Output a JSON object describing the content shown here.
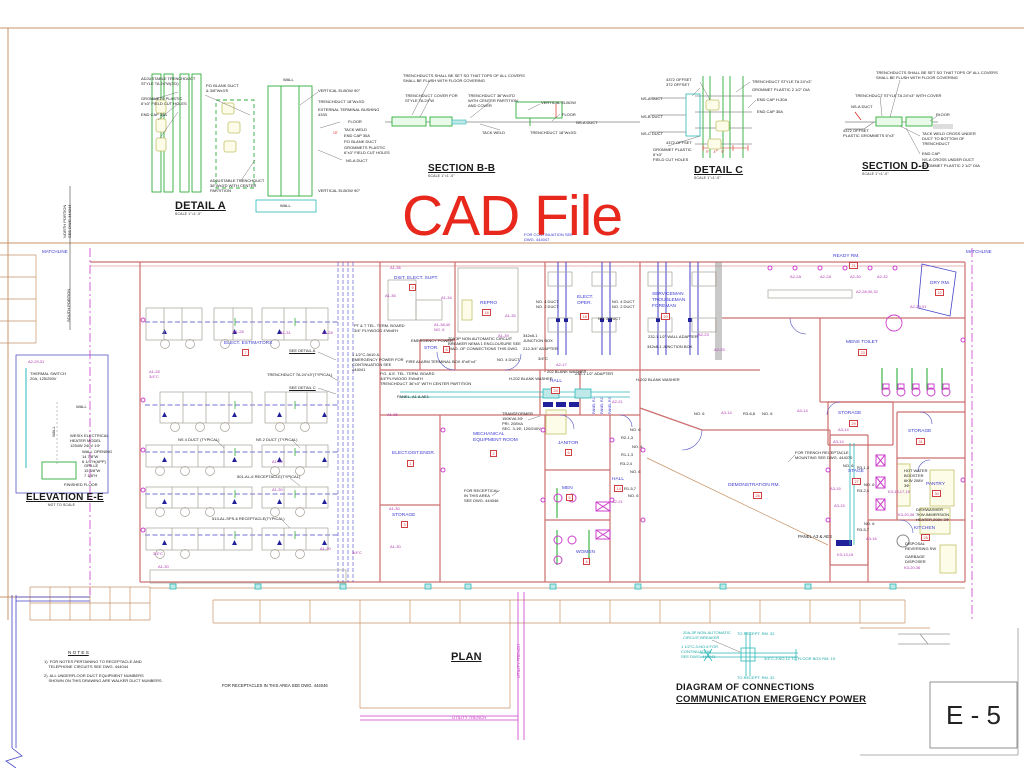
{
  "watermark": {
    "text": "CAD File",
    "color": "#e8281c"
  },
  "sheet": {
    "number": "E - 5"
  },
  "titles": [
    {
      "t": "DETAIL A",
      "x": 175,
      "y": 200,
      "s": 11,
      "u": 1
    },
    {
      "t": "SCALE 1\"=1'-0\"",
      "x": 175,
      "y": 212,
      "s": 3.4,
      "b": 0
    },
    {
      "t": "SECTION B-B",
      "x": 428,
      "y": 163,
      "s": 10,
      "u": 1
    },
    {
      "t": "SCALE 1\"=1'-0\"",
      "x": 428,
      "y": 174,
      "s": 3.4,
      "b": 0
    },
    {
      "t": "DETAIL C",
      "x": 694,
      "y": 164,
      "s": 10.5,
      "u": 1
    },
    {
      "t": "SCALE 1\"=1'-0\"",
      "x": 694,
      "y": 176,
      "s": 3.4,
      "b": 0
    },
    {
      "t": "SECTION D-D",
      "x": 862,
      "y": 161,
      "s": 10,
      "u": 1
    },
    {
      "t": "SCALE 1\"=1'-0\"",
      "x": 862,
      "y": 172,
      "s": 3.4,
      "b": 0
    },
    {
      "t": "ELEVATION E-E",
      "x": 26,
      "y": 492,
      "s": 10,
      "u": 1
    },
    {
      "t": "NOT TO SCALE",
      "x": 48,
      "y": 503,
      "s": 3.4,
      "b": 0
    },
    {
      "t": "PLAN",
      "x": 451,
      "y": 651,
      "s": 11,
      "u": 1
    },
    {
      "t": "DIAGRAM OF CONNECTIONS",
      "x": 676,
      "y": 682,
      "s": 9.5
    },
    {
      "t": "COMMUNICATION EMERGENCY POWER",
      "x": 676,
      "y": 694,
      "s": 9.5,
      "u": 1
    }
  ],
  "rooms": [
    {
      "name": "ELECT. ESTIMATORS",
      "x": 224,
      "y": 341,
      "num": "7",
      "bx": 242,
      "by": 349
    },
    {
      "name": "DIST. ELECT. SUPT.",
      "x": 394,
      "y": 276,
      "num": "9",
      "bx": 409,
      "by": 284
    },
    {
      "name": "REPRO",
      "x": 480,
      "y": 301,
      "num": "16",
      "bx": 482,
      "by": 309
    },
    {
      "name": "ELECT.\nOPER.",
      "x": 577,
      "y": 295,
      "num": "18",
      "bx": 580,
      "by": 313
    },
    {
      "name": "SERVICEMAN\nTROUBLEMAN\nFOREMAN",
      "x": 652,
      "y": 292,
      "num": "20",
      "bx": 661,
      "by": 313
    },
    {
      "name": "READY RM.",
      "x": 833,
      "y": 254,
      "num": "21",
      "bx": 849,
      "by": 262
    },
    {
      "name": "DRY RM.",
      "x": 930,
      "y": 281,
      "num": "22",
      "bx": 935,
      "by": 289
    },
    {
      "name": "MENS TOILET",
      "x": 846,
      "y": 340,
      "num": "23",
      "bx": 858,
      "by": 349
    },
    {
      "name": "STOR.",
      "x": 424,
      "y": 346,
      "num": "8",
      "bx": 443,
      "by": 346
    },
    {
      "name": "HALL",
      "x": 550,
      "y": 379,
      "num": "24",
      "bx": 551,
      "by": 387
    },
    {
      "name": "ELECT.DIST.ENGR.",
      "x": 392,
      "y": 451,
      "num": "1",
      "bx": 407,
      "by": 460
    },
    {
      "name": "MECHANICAL\nEQUIPMENT ROOM",
      "x": 473,
      "y": 432,
      "num": "2",
      "bx": 490,
      "by": 450
    },
    {
      "name": "STORAGE",
      "x": 392,
      "y": 513,
      "num": "3",
      "bx": 401,
      "by": 521
    },
    {
      "name": "JANITOR",
      "x": 558,
      "y": 441,
      "num": "6",
      "bx": 565,
      "by": 449
    },
    {
      "name": "MEN",
      "x": 562,
      "y": 486,
      "num": "5",
      "bx": 566,
      "by": 494
    },
    {
      "name": "WOMEN",
      "x": 576,
      "y": 550,
      "num": "4",
      "bx": 583,
      "by": 558
    },
    {
      "name": "HALL",
      "x": 612,
      "y": 477,
      "num": "14",
      "bx": 614,
      "by": 485
    },
    {
      "name": "DEMONSTRATION RM.",
      "x": 728,
      "y": 483,
      "num": "26",
      "bx": 753,
      "by": 492
    },
    {
      "name": "STAGE",
      "x": 848,
      "y": 469,
      "num": "27",
      "bx": 852,
      "by": 478
    },
    {
      "name": "STORAGE",
      "x": 838,
      "y": 411,
      "num": "29",
      "bx": 849,
      "by": 420
    },
    {
      "name": "STORAGE",
      "x": 908,
      "y": 429,
      "num": "31",
      "bx": 916,
      "by": 438
    },
    {
      "name": "PANTRY",
      "x": 926,
      "y": 482,
      "num": "30",
      "bx": 932,
      "by": 490
    },
    {
      "name": "KITCHEN",
      "x": 914,
      "y": 526,
      "num": "28",
      "bx": 921,
      "by": 534
    }
  ],
  "labels": [
    {
      "t": "ADJUSTABLE TRENCHDUCT\nSTYLE TA 24\"W(3'D)",
      "x": 141,
      "y": 76
    },
    {
      "t": "GROMMETS PLASTIC\n6\"x3\" FIELD CUT HOLES",
      "x": 141,
      "y": 96
    },
    {
      "t": "END CAP 30A",
      "x": 141,
      "y": 112
    },
    {
      "t": "P.D BLANK DUCT\n& 3/8\"Wx3'S",
      "x": 206,
      "y": 83
    },
    {
      "t": "WALL",
      "x": 283,
      "y": 77
    },
    {
      "t": "VERTICAL ELBOW 90°",
      "x": 318,
      "y": 88
    },
    {
      "t": "TRENCHDUCT 18\"Wx3'D",
      "x": 318,
      "y": 99
    },
    {
      "t": "EXTERNAL TERMINAL BUSHING\n4333",
      "x": 318,
      "y": 107
    },
    {
      "t": "FLOOR",
      "x": 348,
      "y": 119
    },
    {
      "t": "TACK WELD",
      "x": 344,
      "y": 127
    },
    {
      "t": "15\"",
      "x": 333,
      "y": 131,
      "c": "#d92a20",
      "s": 3.3
    },
    {
      "t": "END CAP 30A",
      "x": 344,
      "y": 133
    },
    {
      "t": "P.D BLANK DUCT",
      "x": 344,
      "y": 139
    },
    {
      "t": "GROMMETS PLASTIC\n6\"x3\" FIELD CUT HOLES",
      "x": 344,
      "y": 145
    },
    {
      "t": "NS-A DUCT",
      "x": 346,
      "y": 158
    },
    {
      "t": "ADJUSTABLE TRENCHDUCT\n36\"Wx3'D WITH CENTER\nPARTITION",
      "x": 210,
      "y": 178
    },
    {
      "t": "VERTICAL ELBOW 90°",
      "x": 318,
      "y": 188
    },
    {
      "t": "WALL",
      "x": 280,
      "y": 203
    },
    {
      "t": "TRENCHDUCTS SHALL BE SET SO THAT TOPS OF ALL COVERS\nSHALL BE FLUSH WITH FLOOR COVERING",
      "x": 403,
      "y": 73
    },
    {
      "t": "TRENCHDUCT COVER FOR\nSTYLE TA 24\"W",
      "x": 405,
      "y": 93
    },
    {
      "t": "TRENCHDUCT 36\"Wx3\"D\nWITH CENTER PARTITION\nAND COVER",
      "x": 468,
      "y": 93
    },
    {
      "t": "VERTICAL ELBOW",
      "x": 541,
      "y": 100
    },
    {
      "t": "FLOOR",
      "x": 562,
      "y": 112
    },
    {
      "t": "NS-A DUCT",
      "x": 576,
      "y": 120
    },
    {
      "t": "TACK WELD",
      "x": 482,
      "y": 130
    },
    {
      "t": "TRENCHDUCT 18\"Wx3'D",
      "x": 530,
      "y": 130
    },
    {
      "t": "4372 OFFSET\n372 OFFSET",
      "x": 666,
      "y": 77
    },
    {
      "t": "TRENCHDUCT STYLE TA 24\"x3\"",
      "x": 752,
      "y": 79
    },
    {
      "t": "GROMMET PLASTIC 2 1/2\" DIA",
      "x": 752,
      "y": 87
    },
    {
      "t": "END CAP H-30A",
      "x": 757,
      "y": 97
    },
    {
      "t": "END CAP 30A",
      "x": 757,
      "y": 109
    },
    {
      "t": "NS-A DUCT",
      "x": 641,
      "y": 96
    },
    {
      "t": "NS-B DUCT",
      "x": 641,
      "y": 114
    },
    {
      "t": "NS-C DUCT",
      "x": 641,
      "y": 131
    },
    {
      "t": "4372 OFFSET",
      "x": 666,
      "y": 140
    },
    {
      "t": "GROMMET PLASTIC\n6\"x3\"\nFIELD CUT HOLES",
      "x": 653,
      "y": 147
    },
    {
      "t": "9\"     4\"     9\"",
      "x": 706,
      "y": 150,
      "c": "#d92a20",
      "s": 3.3
    },
    {
      "t": "TRENCHDUCTS SHALL BE SET SO THAT TOPS OF ALL COVERS\nSHALL BE FLUSH WITH FLOOR COVERING",
      "x": 876,
      "y": 70
    },
    {
      "t": "TRENCHDUCT STYLE TA 24\"x3\" WITH COVER",
      "x": 855,
      "y": 93
    },
    {
      "t": "NS-A DUCT",
      "x": 851,
      "y": 104
    },
    {
      "t": "FLOOR",
      "x": 936,
      "y": 112
    },
    {
      "t": "4372 OFFSET\nPLASTIC GROMMETS 6\"x3\"",
      "x": 843,
      "y": 128
    },
    {
      "t": "TACK WELD CROSS UNDER\nDUCT TO BOTTOM OF\nTRENCHDUCT",
      "x": 922,
      "y": 131
    },
    {
      "t": "END CAP",
      "x": 922,
      "y": 151
    },
    {
      "t": "NS-A CROSS UNDER DUCT",
      "x": 922,
      "y": 157
    },
    {
      "t": "GROMMET PLASTIC 2 1/2\" DIA",
      "x": 922,
      "y": 163
    },
    {
      "t": "FOR CONTINUATION SEE\nDWG. 444047",
      "x": 524,
      "y": 232,
      "c": "#3b3bd1"
    },
    {
      "t": "MATCHLINE",
      "x": 42,
      "y": 249,
      "c": "#3b3bd1",
      "s": 4.5
    },
    {
      "t": "MATCHLINE",
      "x": 966,
      "y": 249,
      "c": "#3b3bd1",
      "s": 4.5
    },
    {
      "t": "NORTH PORTION\nSEE DWG.444044",
      "x": 62,
      "y": 238,
      "r": -90
    },
    {
      "t": "SOUTH PORTION",
      "x": 66,
      "y": 322,
      "r": -90
    },
    {
      "t": "A2-29,31",
      "x": 28,
      "y": 359,
      "c": "#b03ab0"
    },
    {
      "t": "THERMAL SWITCH\n20A, 125/250V",
      "x": 30,
      "y": 371
    },
    {
      "t": "WALL",
      "x": 76,
      "y": 404
    },
    {
      "t": "WALL",
      "x": 51,
      "y": 437,
      "r": -90
    },
    {
      "t": "WESIX ELECTRICAL\nHEATER MODEL\n1254W 240V 1Φ",
      "x": 70,
      "y": 433
    },
    {
      "t": "WALL OPENING\n14 7/8\"W\n6 1/4\"H(APP)",
      "x": 82,
      "y": 449
    },
    {
      "t": "GRILLE\n15 5/8\"W\n7 1/8\"H",
      "x": 84,
      "y": 463
    },
    {
      "t": "FINISHED FLOOR",
      "x": 64,
      "y": 482
    },
    {
      "t": "SEE DETAIL A",
      "x": 289,
      "y": 348,
      "u": 1
    },
    {
      "t": "TRENCHDUCT TA 24\"x3\"(TYPICAL)",
      "x": 267,
      "y": 372
    },
    {
      "t": "SEE DETAIL C",
      "x": 289,
      "y": 385,
      "u": 1
    },
    {
      "t": "PT & T TEL. TERM. BOARD\n3/4\" PLYWOOD 4'Wx8'H",
      "x": 354,
      "y": 323
    },
    {
      "t": "1 1/2\"C-3#10 &\nEMERGENCY POWER FOR\nCONTINUATION SEE\n444041",
      "x": 352,
      "y": 352
    },
    {
      "t": "NS 4 DUCT (TYPICAL)",
      "x": 178,
      "y": 437
    },
    {
      "t": "NS 2 DUCT (TYPICAL)",
      "x": 256,
      "y": 437
    },
    {
      "t": "501-AL-6 RECEPTACLE(TYPICAL)",
      "x": 237,
      "y": 474
    },
    {
      "t": "513-AL-SPS-6 RECEPTACLE(TYPICAL)",
      "x": 212,
      "y": 516
    },
    {
      "t": "A1-28",
      "x": 233,
      "y": 329,
      "c": "#b03ab0"
    },
    {
      "t": "A1-31",
      "x": 280,
      "y": 330,
      "c": "#b03ab0"
    },
    {
      "t": "A1-28",
      "x": 322,
      "y": 330,
      "c": "#b03ab0"
    },
    {
      "t": "A1-28\n3/4\"C",
      "x": 149,
      "y": 369,
      "c": "#b03ab0"
    },
    {
      "t": "A1-30",
      "x": 272,
      "y": 459,
      "c": "#b03ab0"
    },
    {
      "t": "A1-30",
      "x": 272,
      "y": 487,
      "c": "#b03ab0"
    },
    {
      "t": "3/4\"C",
      "x": 153,
      "y": 551,
      "c": "#b03ab0"
    },
    {
      "t": "A1-30",
      "x": 158,
      "y": 564,
      "c": "#b03ab0"
    },
    {
      "t": "A1-30",
      "x": 320,
      "y": 546,
      "c": "#b03ab0"
    },
    {
      "t": "3/4\"C",
      "x": 352,
      "y": 550,
      "c": "#b03ab0"
    },
    {
      "t": "A1-36",
      "x": 390,
      "y": 265,
      "c": "#b03ab0"
    },
    {
      "t": "A1-36",
      "x": 385,
      "y": 293,
      "c": "#b03ab0"
    },
    {
      "t": "A1-34",
      "x": 441,
      "y": 295,
      "c": "#b03ab0"
    },
    {
      "t": "A1-38,40\nNO. 6",
      "x": 434,
      "y": 322,
      "c": "#b03ab0"
    },
    {
      "t": "A1-35",
      "x": 505,
      "y": 313,
      "c": "#b03ab0"
    },
    {
      "t": "A1-39",
      "x": 498,
      "y": 333,
      "c": "#b03ab0"
    },
    {
      "t": "A1-35",
      "x": 387,
      "y": 412,
      "c": "#b03ab0"
    },
    {
      "t": "A1-30",
      "x": 389,
      "y": 506,
      "c": "#b03ab0"
    },
    {
      "t": "A1-30",
      "x": 390,
      "y": 544,
      "c": "#b03ab0"
    },
    {
      "t": "EMERGENCY POWER",
      "x": 411,
      "y": 338
    },
    {
      "t": "FIRE ALARM TERMINAL BOX 8\"x8\"x4\"",
      "x": 406,
      "y": 359
    },
    {
      "t": "P.G. & E. TEL. TERM. BOARD\n3/4\"PLYWOOD 3'Wx8'H\nTRENCHDUCT 36\"x3\" WITH CENTER PARTITION",
      "x": 380,
      "y": 371
    },
    {
      "t": "PANEL, A1 & AE1",
      "x": 397,
      "y": 394
    },
    {
      "t": "20A 3P NON AUTOMATIC CIRCUIT\nBREAKER NEMA 1 ENCLOUSURE SEE\nDIAG. OF CONNECTIONS THIS DWG.",
      "x": 448,
      "y": 336
    },
    {
      "t": "342x8-1\nJUNCTION BOX",
      "x": 523,
      "y": 333
    },
    {
      "t": "212-3/4\" ADAPTER",
      "x": 523,
      "y": 346
    },
    {
      "t": "NO. 4 DUCT",
      "x": 497,
      "y": 357
    },
    {
      "t": "3/4\"C",
      "x": 538,
      "y": 356
    },
    {
      "t": "A2-17",
      "x": 556,
      "y": 362,
      "c": "#b03ab0"
    },
    {
      "t": "NO. 4 DUCT\nNO. 2 DUCT",
      "x": 536,
      "y": 299
    },
    {
      "t": "NO. 4 DUCT\nNO. 2 DUCT",
      "x": 612,
      "y": 299
    },
    {
      "t": "NO. 2 DUCT",
      "x": 598,
      "y": 316
    },
    {
      "t": "H-202 BLANK WASHER",
      "x": 509,
      "y": 376
    },
    {
      "t": "202 BLANK WASHER",
      "x": 547,
      "y": 369
    },
    {
      "t": "232-1 1/2\" ADAPTER",
      "x": 575,
      "y": 371
    },
    {
      "t": "H-202 BLANK WASHER",
      "x": 636,
      "y": 377
    },
    {
      "t": "232-1 1/2\" WALL ADAPTER",
      "x": 648,
      "y": 334
    },
    {
      "t": "342x8-1 JUNCTION BOX",
      "x": 647,
      "y": 344
    },
    {
      "t": "A2-23",
      "x": 698,
      "y": 332,
      "c": "#b03ab0"
    },
    {
      "t": "A2-25",
      "x": 714,
      "y": 347,
      "c": "#b03ab0"
    },
    {
      "t": "A2-2A",
      "x": 790,
      "y": 274,
      "c": "#b03ab0"
    },
    {
      "t": "A2-2A",
      "x": 820,
      "y": 274,
      "c": "#b03ab0"
    },
    {
      "t": "A2-30",
      "x": 850,
      "y": 274,
      "c": "#b03ab0"
    },
    {
      "t": "A2-32",
      "x": 877,
      "y": 274,
      "c": "#b03ab0"
    },
    {
      "t": "A2-28,30,32",
      "x": 856,
      "y": 289,
      "c": "#b03ab0"
    },
    {
      "t": "A2-29,31",
      "x": 910,
      "y": 304,
      "c": "#b03ab0"
    },
    {
      "t": "A2-21",
      "x": 612,
      "y": 399,
      "c": "#b03ab0"
    },
    {
      "t": "A2-21",
      "x": 612,
      "y": 499,
      "c": "#b03ab0"
    },
    {
      "t": "PANEL R1",
      "x": 592,
      "y": 414,
      "r": -90,
      "c": "#3b3bd1",
      "s": 3.5
    },
    {
      "t": "PANEL R2",
      "x": 600,
      "y": 414,
      "r": -90,
      "c": "#3b3bd1",
      "s": 3.5
    },
    {
      "t": "PANEL R3",
      "x": 608,
      "y": 414,
      "r": -90,
      "c": "#3b3bd1",
      "s": 3.5
    },
    {
      "t": "TRANSFORMER\n150KVA 3Φ\nPRI. 208VΔ\nSEC. 3-1Φ, 120/240V",
      "x": 502,
      "y": 411
    },
    {
      "t": "FOR RECEPTICAL\nIN THIS AREA\nSEE DWG. 444046",
      "x": 464,
      "y": 488
    },
    {
      "t": "NO. 6",
      "x": 630,
      "y": 427
    },
    {
      "t": "R2-1,3",
      "x": 621,
      "y": 435
    },
    {
      "t": "NO. 4",
      "x": 632,
      "y": 444
    },
    {
      "t": "R1-1,3",
      "x": 621,
      "y": 452
    },
    {
      "t": "R3-2,4",
      "x": 620,
      "y": 461
    },
    {
      "t": "NO. 6",
      "x": 630,
      "y": 469
    },
    {
      "t": "R1-5,7",
      "x": 624,
      "y": 486
    },
    {
      "t": "NO. 6",
      "x": 628,
      "y": 493
    },
    {
      "t": "NO. 6",
      "x": 694,
      "y": 411
    },
    {
      "t": "A3-14",
      "x": 721,
      "y": 410,
      "c": "#b03ab0"
    },
    {
      "t": "R3-6,8",
      "x": 743,
      "y": 411
    },
    {
      "t": "NO. 6",
      "x": 762,
      "y": 411
    },
    {
      "t": "A3-14",
      "x": 797,
      "y": 408,
      "c": "#b03ab0"
    },
    {
      "t": "A3-14",
      "x": 838,
      "y": 427,
      "c": "#b03ab0"
    },
    {
      "t": "A3-14",
      "x": 833,
      "y": 439,
      "c": "#b03ab0"
    },
    {
      "t": "FOR TRENCH RECEPTACLE\nMOUNTING SEE DWG. 444070",
      "x": 795,
      "y": 450
    },
    {
      "t": "NO. 6",
      "x": 843,
      "y": 463
    },
    {
      "t": "R3-1,3",
      "x": 857,
      "y": 465
    },
    {
      "t": "A3-15",
      "x": 830,
      "y": 486,
      "c": "#b03ab0"
    },
    {
      "t": "NO. 6",
      "x": 864,
      "y": 482
    },
    {
      "t": "R3-2,4",
      "x": 857,
      "y": 488
    },
    {
      "t": "A3-15",
      "x": 834,
      "y": 503,
      "c": "#b03ab0"
    },
    {
      "t": "NO. 6",
      "x": 864,
      "y": 521
    },
    {
      "t": "R3-5,7",
      "x": 857,
      "y": 527
    },
    {
      "t": "A3-16",
      "x": 866,
      "y": 536,
      "c": "#b03ab0"
    },
    {
      "t": "K3-15,17,19",
      "x": 888,
      "y": 489,
      "c": "#b03ab0"
    },
    {
      "t": "K3-20,36",
      "x": 898,
      "y": 512,
      "c": "#b03ab0"
    },
    {
      "t": "K3-13,15",
      "x": 837,
      "y": 552,
      "c": "#b03ab0"
    },
    {
      "t": "K3-20,36",
      "x": 904,
      "y": 565,
      "c": "#b03ab0"
    },
    {
      "t": "HOT WATER\nBOOSTER\n6KW 208V\n3Φ",
      "x": 904,
      "y": 468
    },
    {
      "t": "DISHWASHER\n7KW-IMMERSION\nHEATER,208V 3Φ",
      "x": 916,
      "y": 507
    },
    {
      "t": "DISPOSAL\nREVERSING SW",
      "x": 905,
      "y": 541
    },
    {
      "t": "GARBAGE\nDISPOSER",
      "x": 905,
      "y": 554
    },
    {
      "t": "PANEL A3 & AE3",
      "x": 798,
      "y": 534,
      "s": 4.4
    },
    {
      "t": "N O T E S",
      "x": 68,
      "y": 650,
      "s": 4.6,
      "u": 1
    },
    {
      "t": "1)  FOR NOTES PERTAINING TO RECEPTACLE AND\n    TELEPHONE CIRCUITS SEE DWG. 444044",
      "x": 44,
      "y": 659
    },
    {
      "t": "2)  ALL UNDERFLOOR DUCT EQUIPMENT NUMBERS\n    SHOWN ON THIS DRAWING ARE WALKER DUCT NUMBERS.",
      "x": 44,
      "y": 673
    },
    {
      "t": "FOR RECEPTACLES IN THIS AREA SEE DWG. 444046",
      "x": 222,
      "y": 683,
      "s": 4.2
    },
    {
      "t": "UTILITY TRENCH",
      "x": 452,
      "y": 715,
      "c": "#cc3fcc",
      "s": 4.2
    },
    {
      "t": "UTILITY TRENCH",
      "x": 516,
      "y": 678,
      "r": -90,
      "c": "#cc3fcc",
      "s": 4.2
    },
    {
      "t": "20A-3P NON-AUTOMATIC\nCIRCUIT BREAKER",
      "x": 683,
      "y": 630,
      "c": "#1ba8a8"
    },
    {
      "t": "TO RECEPT. RM. 32",
      "x": 737,
      "y": 631,
      "c": "#1ba8a8"
    },
    {
      "t": "1 1/2\"C-3-NO.6 FOR\nCONTINUATION\nSEE DWG. 444041",
      "x": 681,
      "y": 644,
      "c": "#1ba8a8"
    },
    {
      "t": "3/4\"C-3 NO.12 TO FLOOR BOX RM. 19",
      "x": 764,
      "y": 656,
      "c": "#1ba8a8"
    },
    {
      "t": "TO RECEPT. RM. 32",
      "x": 737,
      "y": 675,
      "c": "#1ba8a8"
    }
  ]
}
